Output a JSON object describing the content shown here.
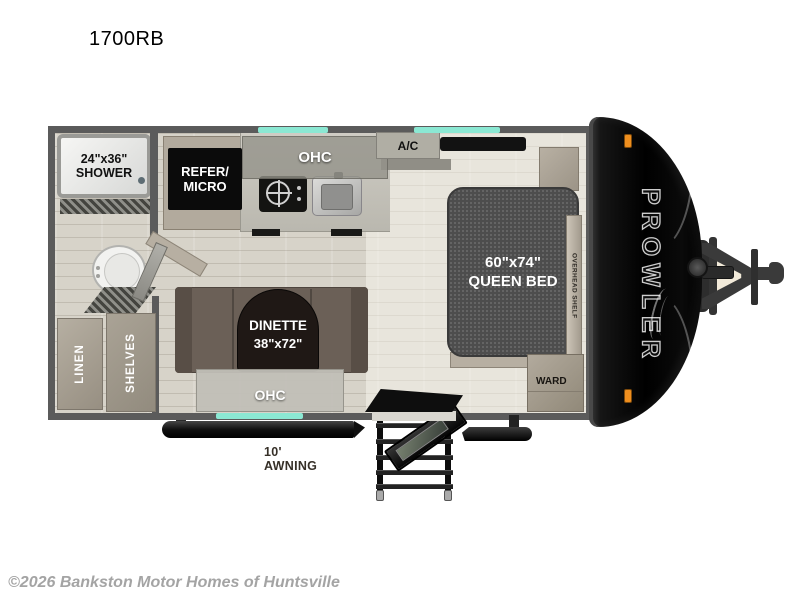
{
  "page": {
    "title": "1700RB",
    "copyright": "©2026 Bankston Motor Homes of Huntsville"
  },
  "colors": {
    "window_accent": "#8be8d3",
    "wall": "#5b5b5b",
    "floor": "#d7d3c9",
    "mattress": "#4d4d4d",
    "dinette_bench": "#6b6057",
    "front_cap": "#000000",
    "marker_light": "#ee8e1e"
  },
  "floorplan": {
    "brand": "PROWLER",
    "rooms": {
      "shower": {
        "line1": "24\"x36\"",
        "line2": "SHOWER"
      },
      "refer_micro": {
        "line1": "REFER/",
        "line2": "MICRO"
      },
      "kitchen_ohc": "OHC",
      "ac": "A/C",
      "queen_bed": {
        "line1": "60\"x74\"",
        "line2": "QUEEN BED"
      },
      "overhead_shelf": "OVERHEAD SHELF",
      "wardrobe": "WARD",
      "dinette": {
        "line1": "DINETTE",
        "line2": "38\"x72\""
      },
      "dinette_ohc": "OHC",
      "linen": "LINEN",
      "shelves": "SHELVES"
    },
    "exterior": {
      "awning": "10' AWNING"
    }
  }
}
